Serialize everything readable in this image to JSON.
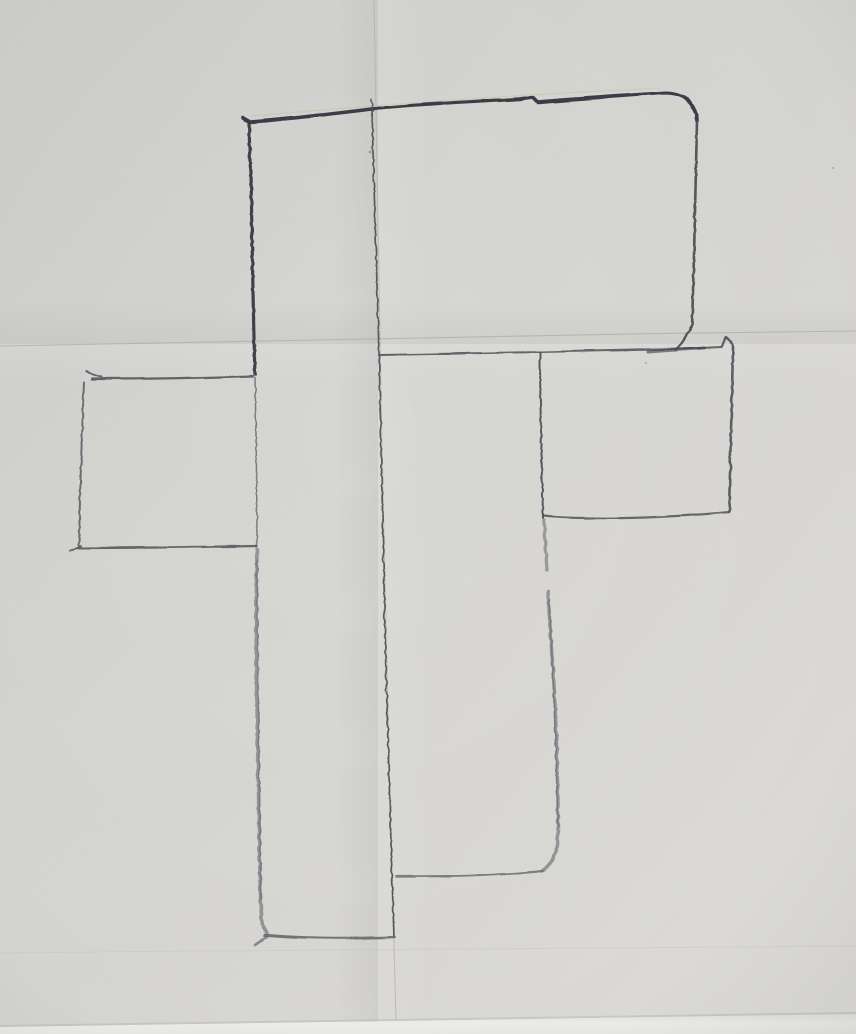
{
  "scene": {
    "type": "photograph",
    "subject": "hand-drawn pencil outline sketch of a cross-shaped plan on a folded sheet of gray paper",
    "paper": {
      "base_color": "#d6d6d3",
      "top_left_shade": "#cfcfcd",
      "bottom_right_light": "#e3e2df",
      "bottom_edge_band": "#f1f2ef"
    },
    "pencil": {
      "dark": "#34343e",
      "medium": "#55555c",
      "soft": "#84848a"
    },
    "creases": {
      "color": "#a8a8a4",
      "vertical_fold_x": 380,
      "horizontal_fold_y": 340
    }
  },
  "drawing": {
    "viewbox": "0 0 856 1034",
    "paths": [
      {
        "name": "vertical-fold-crease",
        "layer": "crease",
        "d": "M374,0 C377,200 383,520 389,760 C392,860 394,950 396,1020",
        "stroke": "#adadaa",
        "w": 1.1,
        "op": 0.6
      },
      {
        "name": "horizontal-fold-crease-top",
        "layer": "crease",
        "d": "M0,346 C240,341 560,334 856,331",
        "stroke": "#a2a2a0",
        "w": 1.1,
        "op": 0.55
      },
      {
        "name": "horizontal-fold-crease-bottom",
        "layer": "crease",
        "d": "M0,953 C300,950 620,947 856,946",
        "stroke": "#c4c4c0",
        "w": 1.0,
        "op": 0.35
      },
      {
        "name": "bottom-edge-shadow-line",
        "layer": "crease",
        "d": "M0,1026 L856,1013",
        "stroke": "#b9b9b5",
        "w": 2.0,
        "op": 0.5
      },
      {
        "name": "outline-top-edge",
        "layer": "pencil",
        "d": "M243,118 L250,122 C290,119 330,114 372,109 C410,105 470,102 520,99 L533,97 L538,102 C570,99 620,96 662,93 C674,92 686,96 691,104 C695,110 697,114 697,121",
        "stroke": "#34343e",
        "w": 3.6,
        "op": 0.95
      },
      {
        "name": "outline-top-edge-sheen",
        "layer": "crease",
        "d": "M252,116 C330,109 470,97 660,88",
        "stroke": "#c8b97c",
        "w": 1.3,
        "op": 0.3
      },
      {
        "name": "outline-topblock-right-edge",
        "layer": "pencil",
        "d": "M697,121 C696,180 694,260 692,327",
        "stroke": "#46464e",
        "w": 2.6,
        "op": 0.9
      },
      {
        "name": "outline-topblock-zigzag",
        "layer": "pencil",
        "d": "M692,327 L676,350",
        "stroke": "#46464e",
        "w": 2.4,
        "op": 0.9
      },
      {
        "name": "outline-rightarm-top-edge",
        "layer": "pencil",
        "d": "M380,355 C440,354 500,353 540,352 C590,351 646,350 678,349 L722,347",
        "stroke": "#55555c",
        "w": 2.0,
        "op": 0.9
      },
      {
        "name": "outline-rightarm-top-overdraw",
        "layer": "pencil",
        "d": "M648,352 L704,348",
        "stroke": "#3c3c44",
        "w": 3.0,
        "op": 0.6
      },
      {
        "name": "outline-rightarm-corner-hook",
        "layer": "pencil",
        "d": "M722,347 L726,337 C730,339 733,342 733,348",
        "stroke": "#4c4c54",
        "w": 2.2,
        "op": 0.9
      },
      {
        "name": "outline-rightarm-right-edge",
        "layer": "pencil",
        "d": "M733,348 C732,400 730,460 729,512",
        "stroke": "#50505a",
        "w": 2.6,
        "op": 0.9
      },
      {
        "name": "outline-rightarm-bottom-edge",
        "layer": "pencil",
        "d": "M729,512 C690,516 630,519 588,518 C566,518 553,517 543,516",
        "stroke": "#5a5a62",
        "w": 2.2,
        "op": 0.9
      },
      {
        "name": "outline-inner-vertical-upper",
        "layer": "pencil",
        "d": "M540,353 C540,410 542,470 543,518",
        "stroke": "#4c4c54",
        "w": 2.0,
        "op": 0.92
      },
      {
        "name": "outline-inner-vertical-mid",
        "layer": "pencil",
        "d": "M544,520 C545,538 546,556 547,570",
        "stroke": "#84848a",
        "w": 3.2,
        "op": 0.75
      },
      {
        "name": "outline-inner-vertical-lower",
        "layer": "pencil",
        "d": "M548,592 C550,630 552,655 553,668 C556,710 557,760 558,800 L558,827 C558,844 556,856 551,862 C548,866 545,869 542,871",
        "stroke": "#82828a",
        "w": 3.4,
        "op": 0.8
      },
      {
        "name": "outline-inner-vertical-lower-core",
        "layer": "pencil",
        "d": "M549,600 C552,650 555,720 557,790 L558,826",
        "stroke": "#6e6e76",
        "w": 1.4,
        "op": 0.75
      },
      {
        "name": "outline-lowerright-bottom-edge",
        "layer": "pencil",
        "d": "M542,871 C505,875 450,877 396,877",
        "stroke": "#6c6c72",
        "w": 2.3,
        "op": 0.85
      },
      {
        "name": "outline-fold-drawn-line",
        "layer": "pencil",
        "d": "M372,108 C374,200 377,300 379,352 C381,450 384,560 386,675 C388,760 391,830 392,876 L394,937",
        "stroke": "#4a4a52",
        "w": 1.7,
        "op": 0.9
      },
      {
        "name": "outline-fold-top-tick",
        "layer": "pencil",
        "d": "M371,99 L373,111",
        "stroke": "#4a4a52",
        "w": 1.6,
        "op": 0.85
      },
      {
        "name": "outline-center-left-edge-upper",
        "layer": "pencil",
        "d": "M249,123 C250,150 249,160 251,172 C252,240 253,310 255,374",
        "stroke": "#36363e",
        "w": 3.2,
        "op": 0.95
      },
      {
        "name": "outline-center-left-edge-mid",
        "layer": "pencil",
        "d": "M255,377 C256,430 257,495 257,546",
        "stroke": "#6a6a72",
        "w": 1.5,
        "op": 0.85
      },
      {
        "name": "outline-center-left-edge-lower",
        "layer": "pencil",
        "d": "M257,549 C256,610 256,660 257,705 C258,770 259,830 260,878 L261,911 C261,922 263,929 267,933",
        "stroke": "#808088",
        "w": 3.6,
        "op": 0.78
      },
      {
        "name": "outline-center-left-edge-lower-core",
        "layer": "pencil",
        "d": "M257,560 C257,650 259,780 261,900",
        "stroke": "#6c6c74",
        "w": 1.5,
        "op": 0.65
      },
      {
        "name": "outline-center-corner-tail",
        "layer": "pencil",
        "d": "M268,936 L255,945",
        "stroke": "#76767e",
        "w": 2.6,
        "op": 0.8
      },
      {
        "name": "outline-center-bottom-edge",
        "layer": "pencil",
        "d": "M265,935 C300,938 350,939 394,937",
        "stroke": "#68686e",
        "w": 2.5,
        "op": 0.9
      },
      {
        "name": "outline-leftarm-top-hook",
        "layer": "pencil",
        "d": "M86,371 C91,374 95,376 101,377",
        "stroke": "#54545c",
        "w": 2.0,
        "op": 0.85
      },
      {
        "name": "outline-leftarm-top-edge",
        "layer": "pencil",
        "d": "M92,379 C140,379 200,378 253,376",
        "stroke": "#54545c",
        "w": 2.3,
        "op": 0.9
      },
      {
        "name": "outline-leftarm-left-edge",
        "layer": "pencil",
        "d": "M84,382 C82,430 80,490 79,546",
        "stroke": "#60606a",
        "w": 2.0,
        "op": 0.9
      },
      {
        "name": "outline-leftarm-bottom-hook",
        "layer": "pencil",
        "d": "M70,551 L81,546",
        "stroke": "#58585e",
        "w": 2.2,
        "op": 0.85
      },
      {
        "name": "outline-leftarm-bottom-edge",
        "layer": "pencil",
        "d": "M77,548 C130,548 200,547 257,546",
        "stroke": "#58585e",
        "w": 2.3,
        "op": 0.9
      }
    ],
    "specks": [
      {
        "name": "pencil-speck",
        "x": 370,
        "y": 152,
        "r": 1.3,
        "op": 0.5
      },
      {
        "name": "pencil-speck",
        "x": 833,
        "y": 168,
        "r": 1.1,
        "op": 0.3
      },
      {
        "name": "pencil-speck",
        "x": 646,
        "y": 363,
        "r": 1.1,
        "op": 0.28
      }
    ]
  }
}
